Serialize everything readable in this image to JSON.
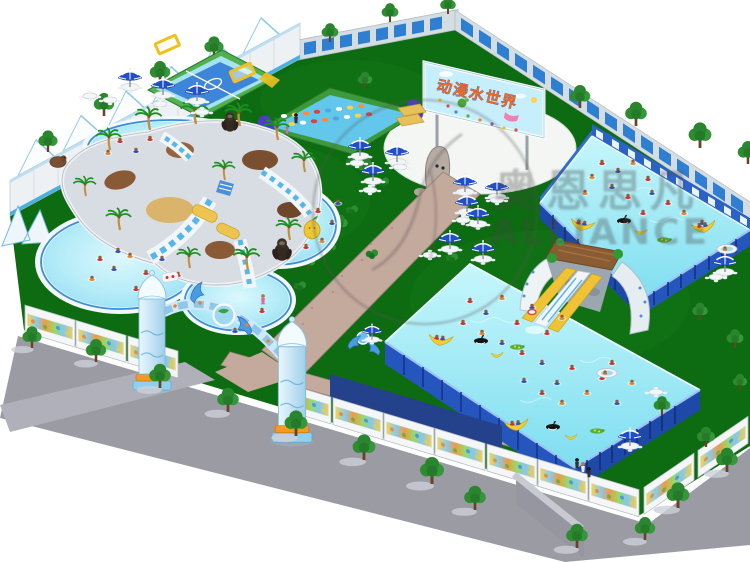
{
  "image": {
    "alt": "Aerial 3D rendering of an inflatable water park with pools, slides and entrance arch"
  },
  "billboard": {
    "title": "动漫水世界"
  },
  "watermark": {
    "cjk": "奥恩思凡",
    "latin": "ALLIANCE"
  },
  "palette": {
    "background": "#ffffff",
    "lawn": "#0d6b11",
    "pool_water": "#aeeaf7",
    "frame_pool_water": "#8fe6f4",
    "frame_blue": "#2456bd",
    "gravel_path": "#c4a99d",
    "sidewalk": "#9b9ba4",
    "navy_wall": "#24418c",
    "billboard_bg": "#c6eefb",
    "billboard_title_color": "#f26a1a",
    "umbrella_blue": "#2050c8",
    "tree_green": "#2e8b2e",
    "slide_yellow": "#f0c335",
    "accent_orange": "#f59a20",
    "dome_blue": "#bfe3f5"
  },
  "features": {
    "perimeter_wall": "white wall with sail fins",
    "sports_court": "inflatable water soccer court",
    "obstacle_course": "floating stepping-pod course",
    "pool_cluster": "round pools around palm slide island",
    "frame_pool_upper": "steel frame pool with swimmers",
    "frame_pool_lower": "steel frame pool with swimmers",
    "arch_slide": "rock arch slide with thatched hut",
    "entrance_arch": "dolphin entrance arch with dome columns",
    "mural_fence": "white fence with cartoon murals",
    "umbrellas": "blue and white parasols with tables",
    "floats": "banana, orca and boat pool floats",
    "watermark": "semi-transparent logo watermark"
  }
}
